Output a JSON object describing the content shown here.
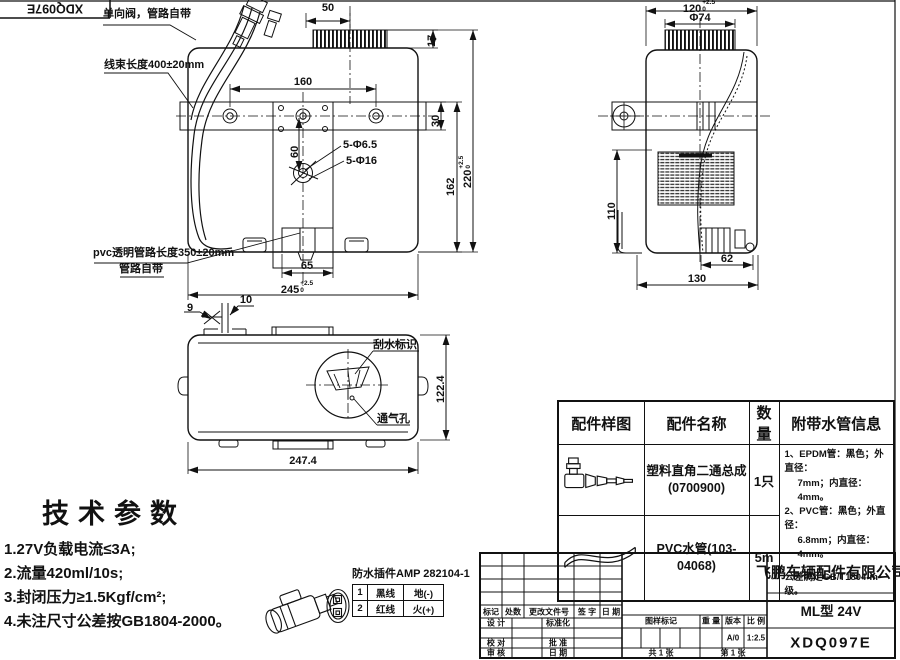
{
  "sheet": {
    "corner_code": "XDQ097E"
  },
  "front_view": {
    "callouts": {
      "check_valve": "单向阀，管路自带",
      "harness_length": "线束长度400±20mm",
      "pvc_tube_1": "pvc透明管路长度350±20mm",
      "pvc_tube_2": "管路自带",
      "holes_small": "5-Φ6.5",
      "holes_big": "5-Φ16"
    },
    "dims": {
      "cap_w": "50",
      "cap_h": "17",
      "hole_span": "160",
      "band_h": "30",
      "hole_off": "60",
      "body_h": "162",
      "height": "220",
      "height_tol_up": "+2.5",
      "height_tol_dn": "0",
      "pump_span": "65",
      "width": "245",
      "width_tol_up": "+2.5",
      "width_tol_dn": "0"
    }
  },
  "side_view": {
    "dims": {
      "depth": "120",
      "depth_tol_up": "+2.5",
      "depth_tol_dn": "0",
      "cap_dia": "Φ74",
      "body_h": "110",
      "pump_off": "62",
      "base_w": "130"
    }
  },
  "top_view": {
    "callouts": {
      "wiper_mark": "刮水标识",
      "vent_hole": "通气孔"
    },
    "dims": {
      "clip_a": "9",
      "clip_b": "10",
      "depth": "122.4",
      "width": "247.4"
    }
  },
  "tech_params": {
    "title": "技术参数",
    "items": [
      "1.27V负载电流≤3A;",
      "2.流量420ml/10s;",
      "3.封闭压力≥1.5Kgf/cm²;",
      "4.未注尺寸公差按GB1804-2000。"
    ]
  },
  "connector": {
    "title": "防水插件AMP 282104-1",
    "pins": [
      {
        "no": "1",
        "wire": "黑线",
        "role": "地(-)"
      },
      {
        "no": "2",
        "wire": "红线",
        "role": "火(+)"
      }
    ]
  },
  "parts_table": {
    "headers": [
      "配件样图",
      "配件名称",
      "数量",
      "附带水管信息"
    ],
    "rows": [
      {
        "name": "塑料直角二通总成",
        "code": "(0700900)",
        "qty": "1只"
      },
      {
        "name": "PVC水管(103-04068)",
        "code": "",
        "qty": "5m"
      }
    ],
    "pipe_info": [
      "1、EPDM管：黑色；外直径：",
      "7mm；内直径：4mm。",
      "2、PVC管：黑色；外直径：",
      "6.8mm；内直径：4mm。",
      "公差满足GB/T1804-m级。"
    ]
  },
  "title_block": {
    "company": "飞鹏车辆配件有限公司",
    "model": "ML型 24V",
    "drawing_no": "XDQ097E",
    "rev_headers": [
      "标记",
      "处数",
      "更改文件号",
      "签 字",
      "日 期"
    ],
    "roles": {
      "design": "设 计",
      "standard": "标准化",
      "check": "校 对",
      "approve": "批 准",
      "audit": "审 核",
      "date": "日 期"
    },
    "mark_label": "图样标记",
    "weight_label": "重 量",
    "version_label": "版本",
    "scale_label": "比 例",
    "version": "A/0",
    "scale": "1:2.5",
    "sheet_total": "共 1 张",
    "sheet_index": "第 1 张"
  }
}
